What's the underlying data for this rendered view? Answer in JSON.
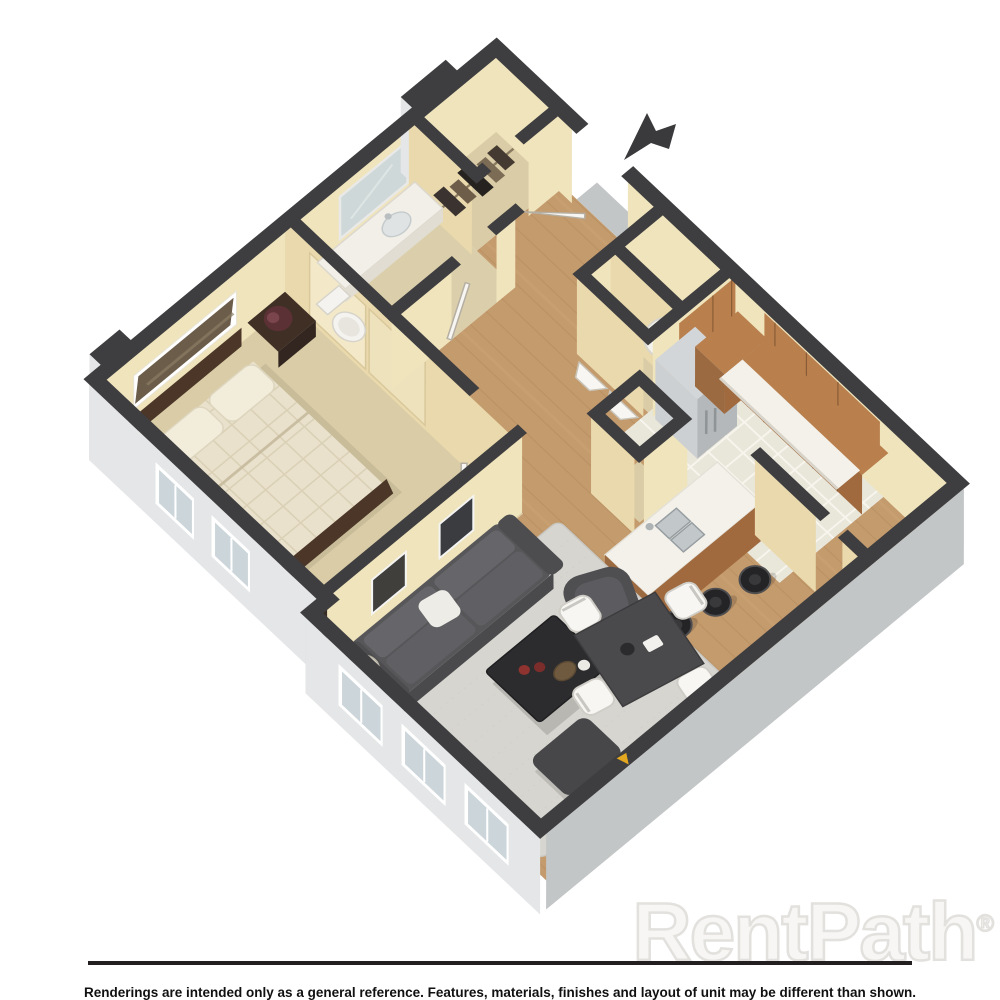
{
  "branding": {
    "watermark_text": "RentPath",
    "registered_mark": "®"
  },
  "footer": {
    "disclaimer": "Renderings are intended only as a general reference. Features, materials, finishes and layout of unit may be different than shown."
  },
  "floorplan": {
    "type": "3d-isometric-floorplan",
    "unit_style": "one-bedroom apartment",
    "rooms": [
      "bedroom",
      "bathroom",
      "coat-closet",
      "entry",
      "laundry-utility",
      "kitchen",
      "dining-area",
      "living-room",
      "hallway"
    ],
    "features": [
      "entry-direction-arrow",
      "queen-bed",
      "nightstands-with-lamps",
      "wall-art",
      "sliding-closet-doors",
      "vanity-with-mirror",
      "toilet",
      "water-heater",
      "bifold-laundry-doors",
      "refrigerator",
      "l-shaped-cabinets",
      "kitchen-island-with-double-sink",
      "three-bar-stools",
      "square-dining-table",
      "four-white-chairs",
      "sectional-sofa",
      "coffee-table",
      "armchair",
      "ottoman",
      "shag-rug",
      "floor-lamp",
      "bedroom-windows",
      "living-room-windows"
    ]
  },
  "colors": {
    "wall": "#3e3e40",
    "face-lit": "#f0e4bd",
    "face-shade": "#e9d9ac",
    "ext-light": "#e4e6e7",
    "ext-mid": "#c3c6c7",
    "wood": "#c49b6d",
    "plank": "#a97f52",
    "tile": "#e9e6da",
    "carpet": "#d9cca6",
    "cabinet": "#b9804e",
    "cabinet-dark": "#a06a3e",
    "counter": "#f3f1ea",
    "steel": "#c6c9cc",
    "rug": "#d7d5d0",
    "sofa": "#57575a",
    "dark-furn": "#2c2c2e",
    "bed": "#e9e1cc",
    "frame": "#4b3628",
    "window-glass": "#ccd5d9",
    "divider": "#231f20",
    "watermark": "#e3e1de"
  }
}
